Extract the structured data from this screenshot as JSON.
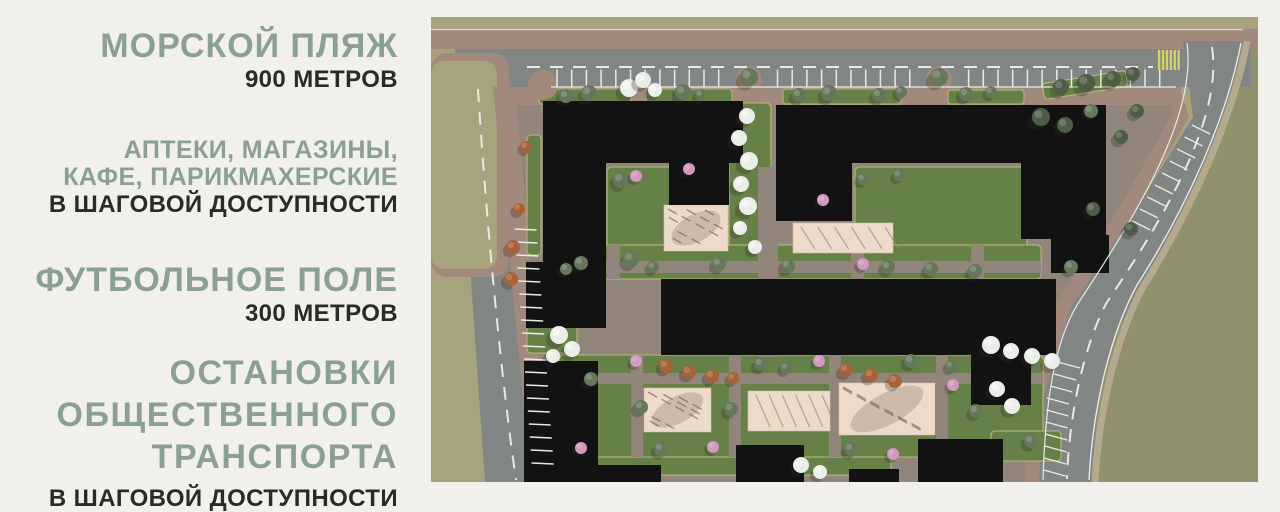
{
  "page": {
    "background": "#f1f0ec"
  },
  "panel": {
    "accent_color": "#8ba095",
    "dark_color": "#2a2a27",
    "blocks": {
      "beach": {
        "title": "МОРСКОЙ ПЛЯЖ",
        "subtitle": "900 МЕТРОВ"
      },
      "services": {
        "line1": "АПТЕКИ, МАГАЗИНЫ,",
        "line2": "КАФЕ, ПАРИКМАХЕРСКИЕ",
        "subtitle": "В ШАГОВОЙ ДОСТУПНОСТИ"
      },
      "football": {
        "title": "ФУТБОЛЬНОЕ ПОЛЕ",
        "subtitle": "300 МЕТРОВ"
      },
      "transport": {
        "line1": "ОСТАНОВКИ",
        "line2": "ОБЩЕСТВЕННОГО",
        "line3": "ТРАНСПОРТА",
        "subtitle": "В ШАГОВОЙ ДОСТУПНОСТИ"
      }
    }
  },
  "map": {
    "kind": "aerial-site-plan-render",
    "colors": {
      "grass_light": "#a3a077",
      "grass_dark": "#8d8c66",
      "asphalt": "#7b7f7d",
      "sidewalk": "#9c8377",
      "paving": "#8d7f75",
      "lawn": "#5d7b3e",
      "lawn_edge": "#b9b878",
      "building": "#060606",
      "playground": "#ecd9c8",
      "marking": "#e9e9e3",
      "crosswalk": "#d6ce62",
      "tree_green": "#5e7153",
      "tree_dark": "#46543d",
      "tree_white": "#eaece7",
      "tree_pink": "#cf93bd",
      "tree_rust": "#a25b2e"
    }
  }
}
